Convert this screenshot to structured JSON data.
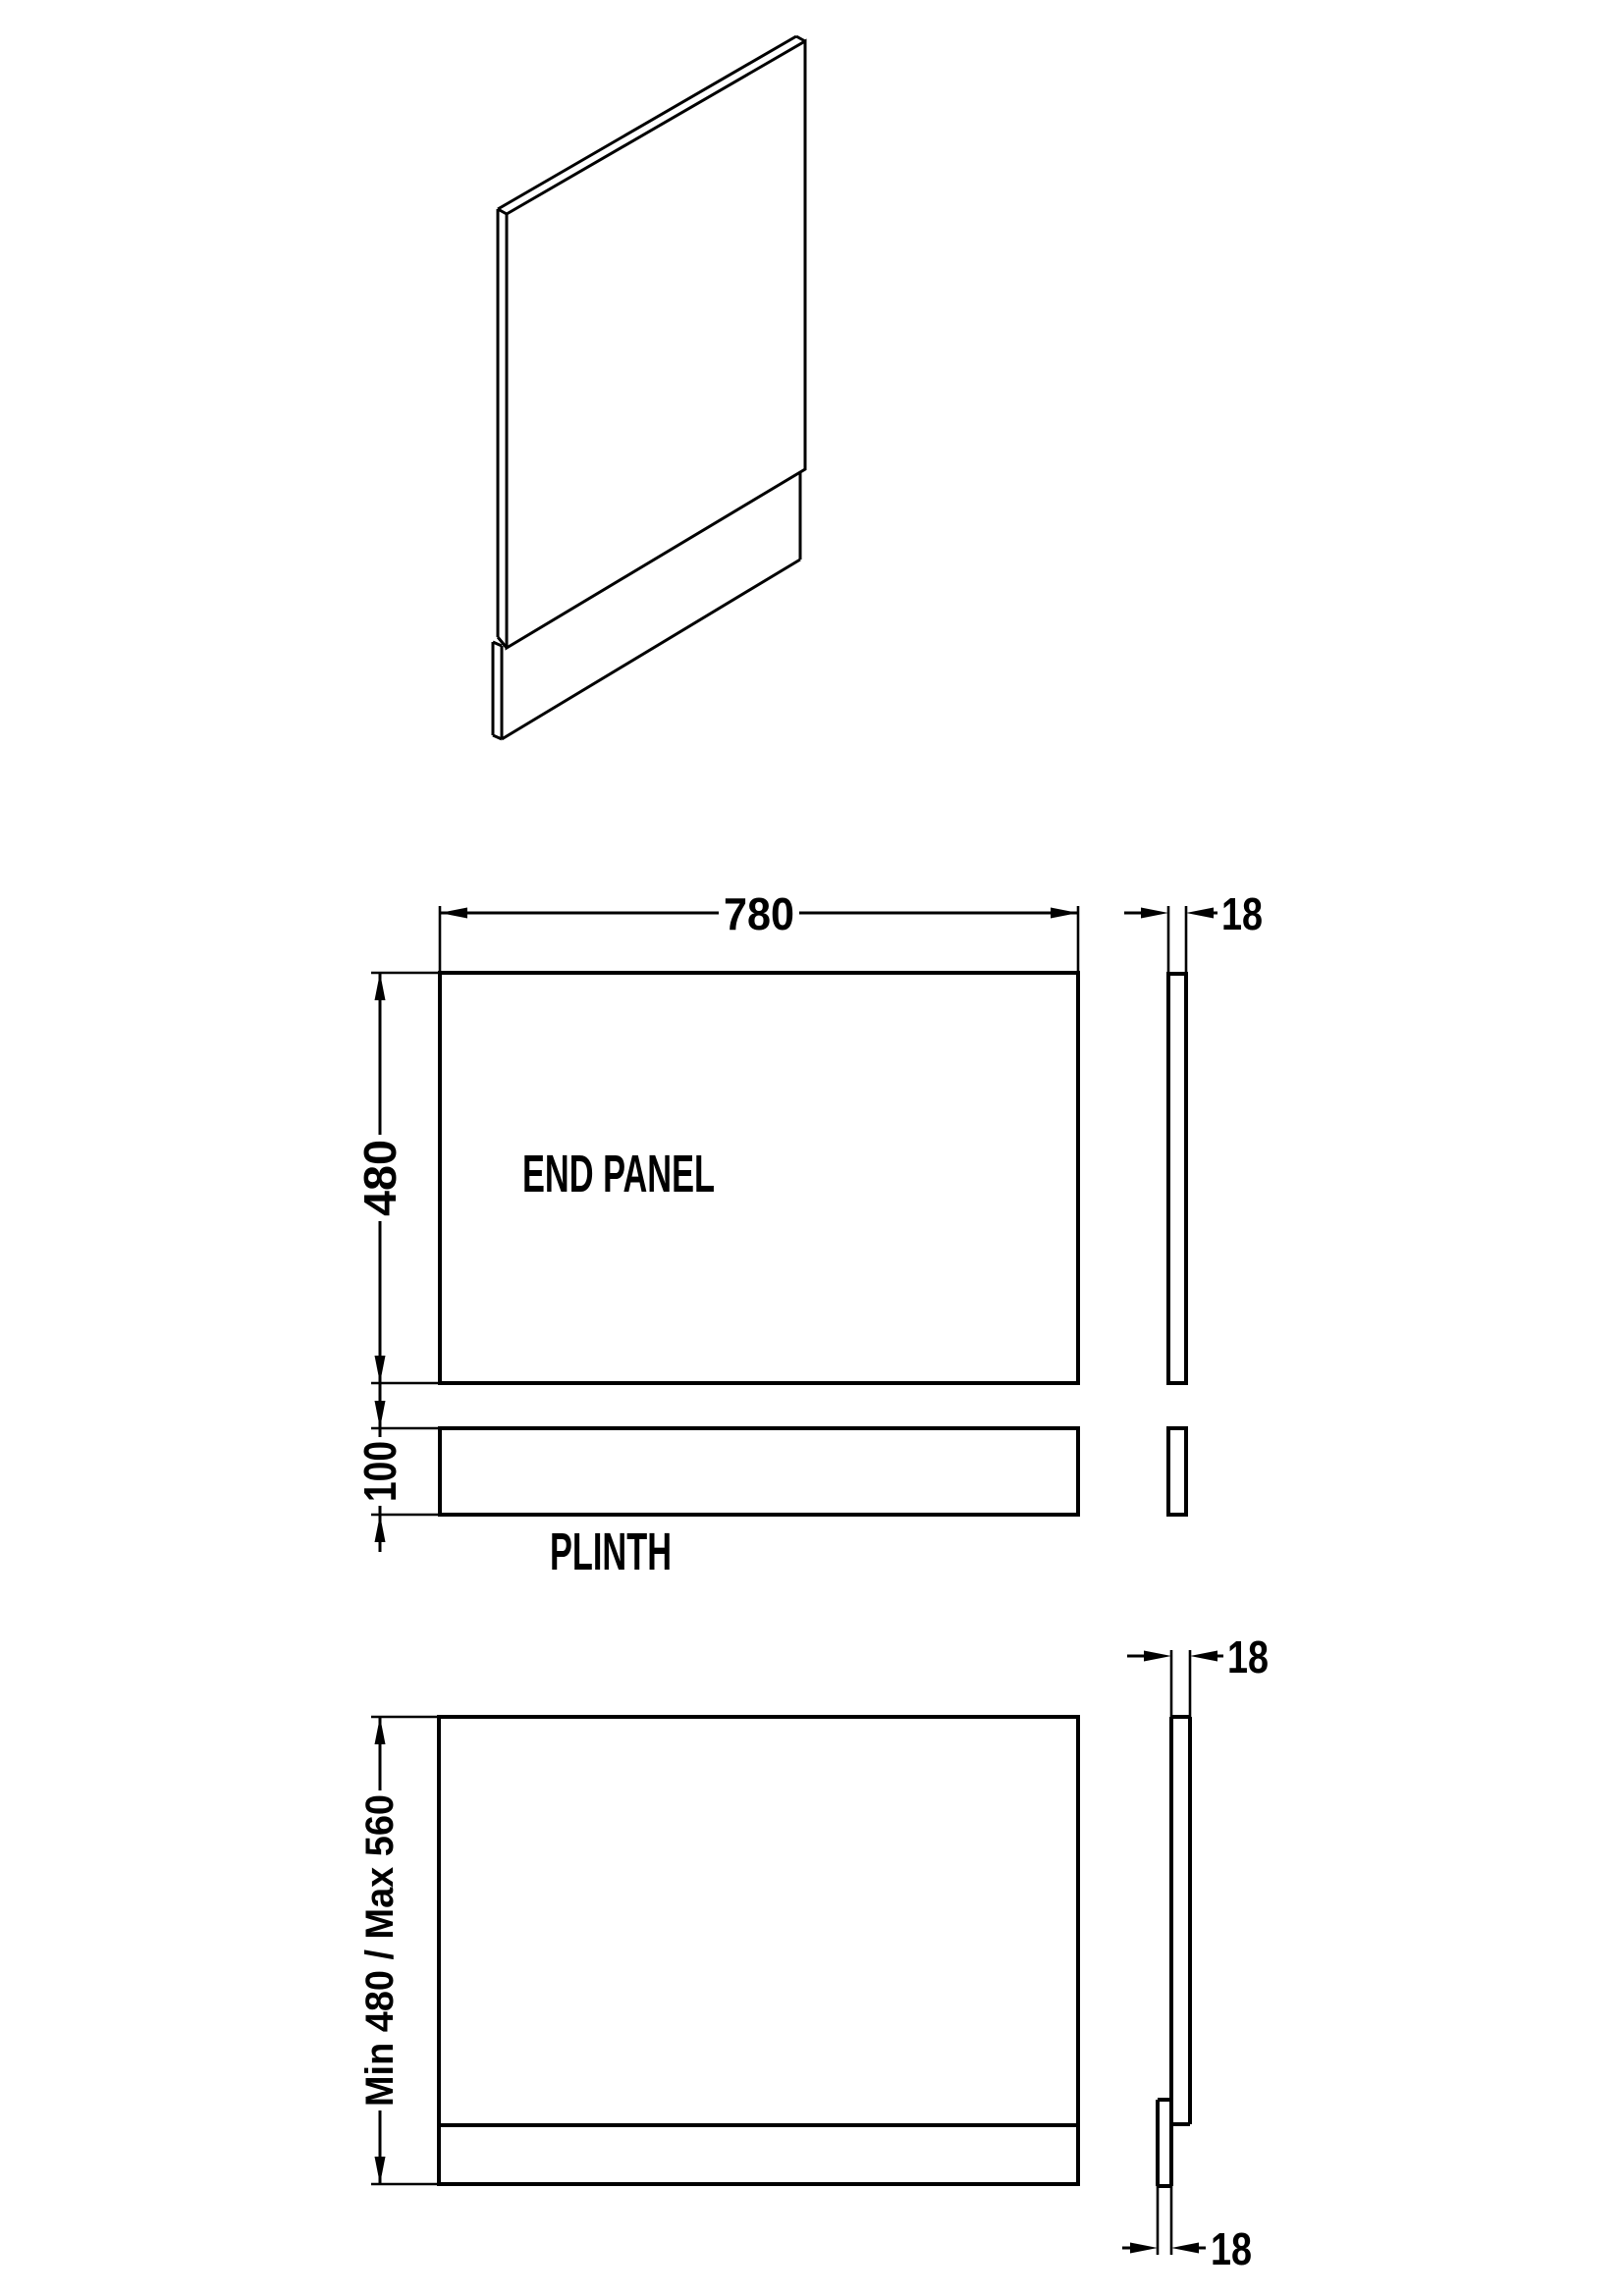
{
  "drawing": {
    "end_panel": {
      "label": "END PANEL",
      "width": "780",
      "height": "480",
      "thickness": "18"
    },
    "plinth": {
      "label": "PLINTH",
      "height": "100"
    },
    "assembled": {
      "height": "Min 480 / Max 560",
      "thickness_top": "18",
      "thickness_bottom": "18"
    }
  }
}
